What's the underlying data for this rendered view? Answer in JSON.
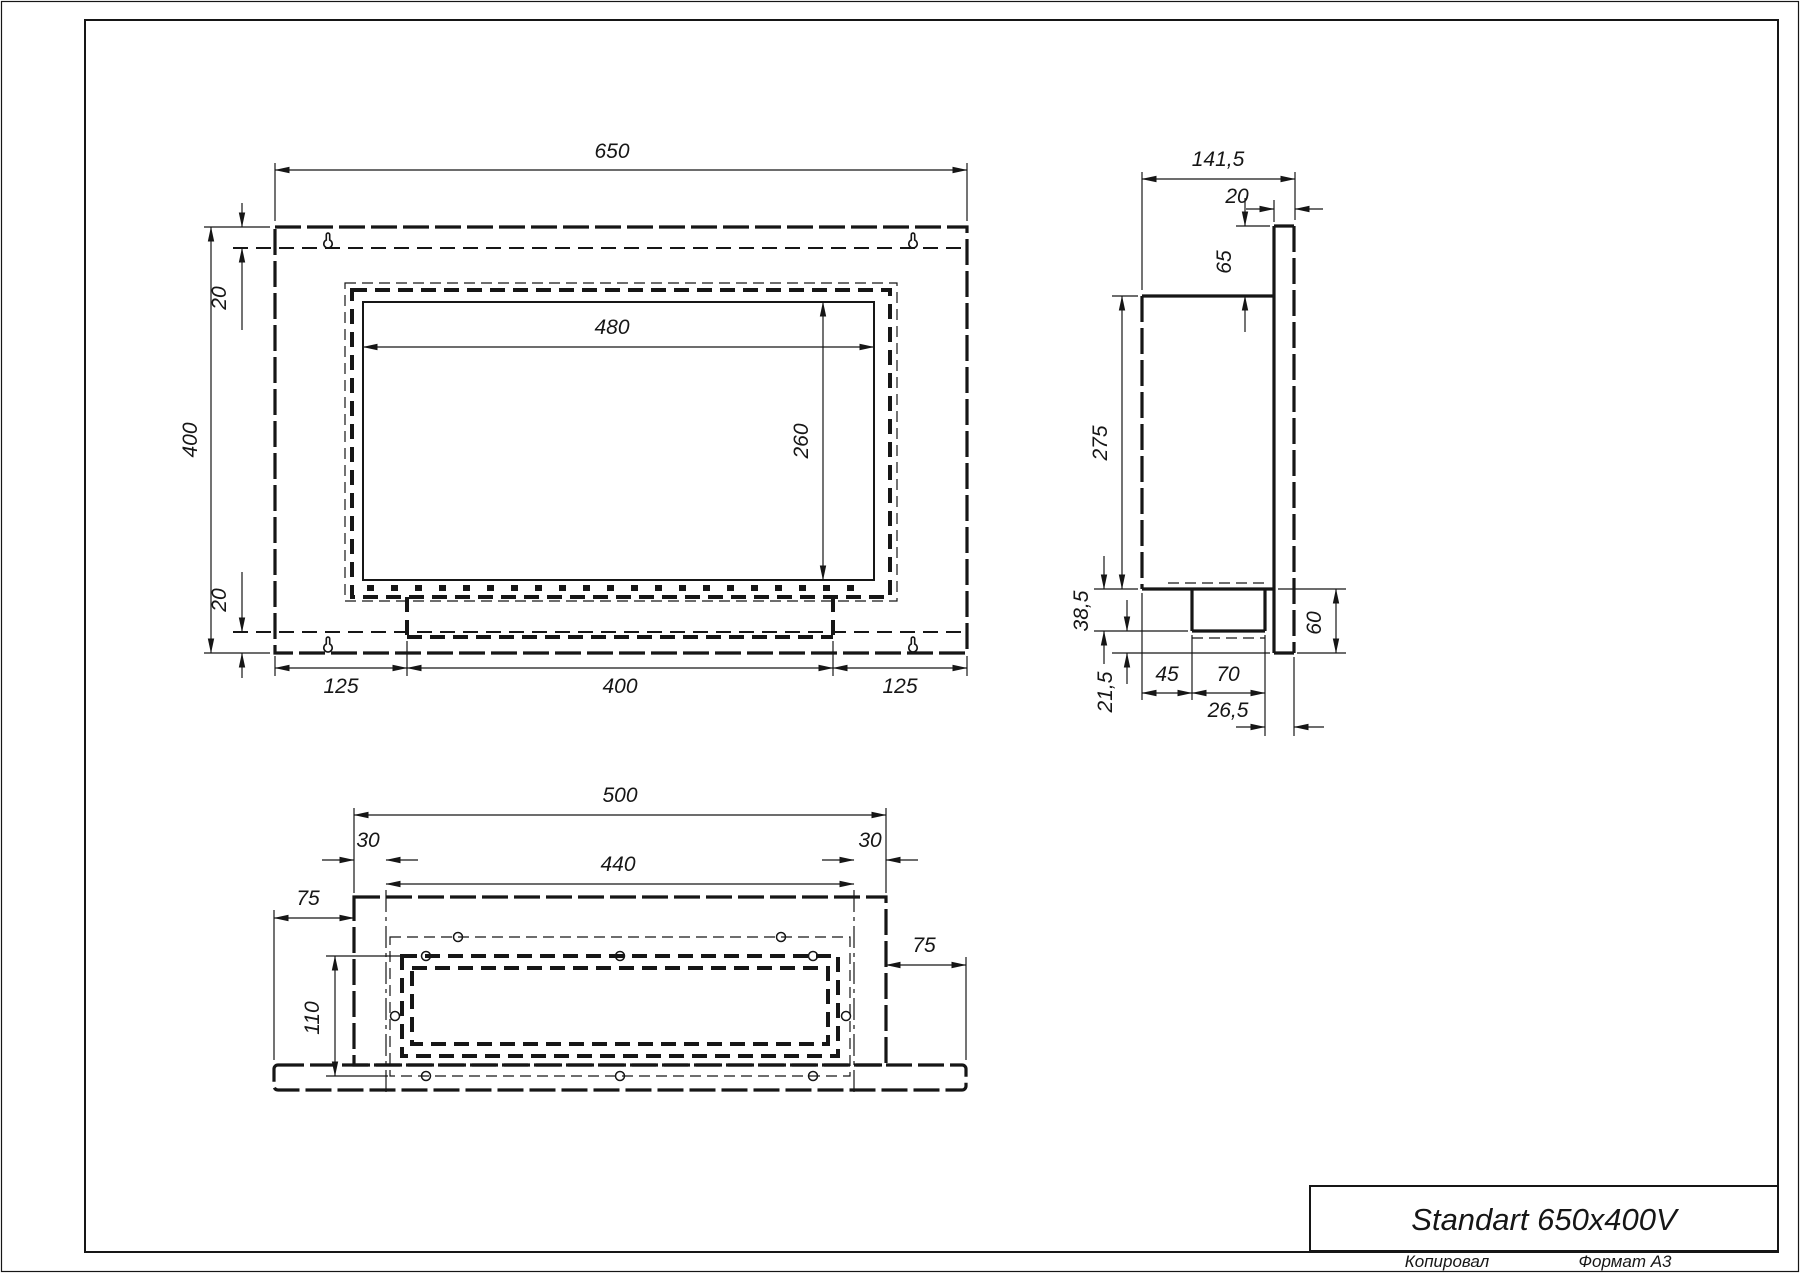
{
  "title_block": {
    "product_name": "Standart 650x400V"
  },
  "footer": {
    "copied_by": "Копировал",
    "format": "Формат А3"
  },
  "front_view": {
    "dim_overall_width": "650",
    "dim_overall_height": "400",
    "dim_top_inset": "20",
    "dim_bottom_inset": "20",
    "dim_opening_width": "480",
    "dim_opening_height": "260",
    "dim_bottom_left": "125",
    "dim_bottom_center": "400",
    "dim_bottom_right": "125"
  },
  "side_view": {
    "dim_overall_depth": "141,5",
    "dim_flange_thickness": "20",
    "dim_top_offset": "65",
    "dim_body_height": "275",
    "dim_lower_box_height": "38,5",
    "dim_bottom_offset": "21,5",
    "dim_front_clearance": "45",
    "dim_duct_width": "70",
    "dim_rear_clearance": "26,5",
    "dim_lower_right_height": "60"
  },
  "bottom_view": {
    "dim_box_width": "500",
    "dim_left_inset": "30",
    "dim_opening_width": "440",
    "dim_right_inset": "30",
    "dim_left_flange": "75",
    "dim_right_flange": "75",
    "dim_opening_depth": "110"
  }
}
